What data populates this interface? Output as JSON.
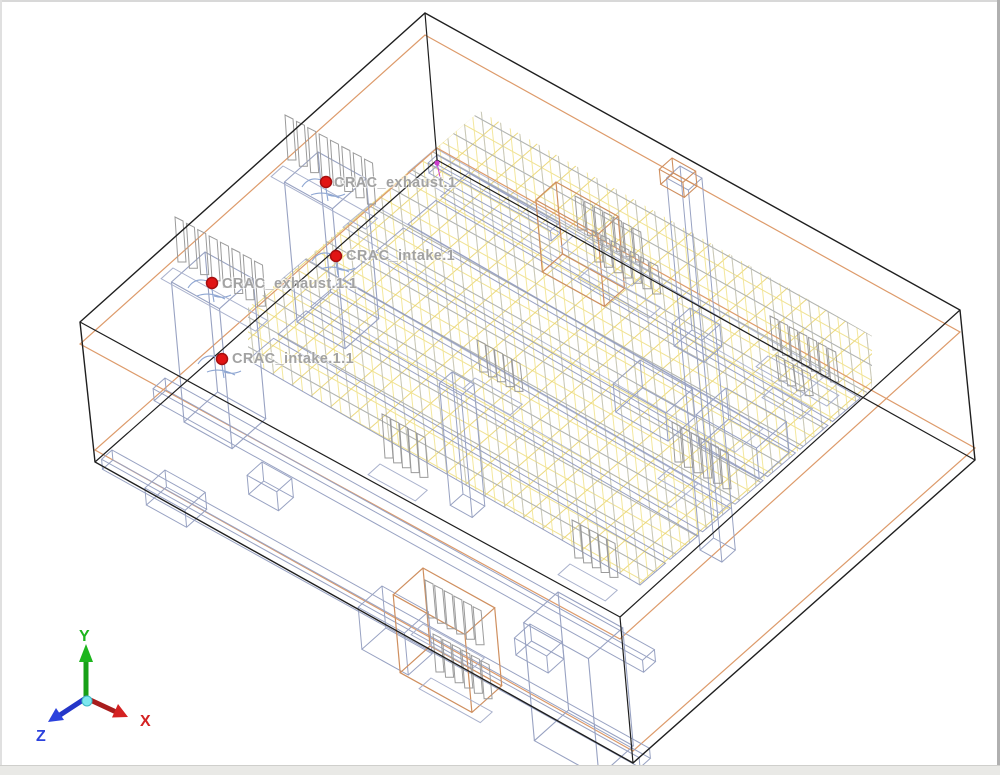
{
  "app": {
    "view_name": "3d-model-viewport"
  },
  "probes": [
    {
      "label": "CRAC_exhaust.1"
    },
    {
      "label": "CRAC_intake.1"
    },
    {
      "label": "CRAC_exhaust.1.1"
    },
    {
      "label": "CRAC_intake.1.1"
    }
  ],
  "axis": {
    "x": "X",
    "y": "Y",
    "z": "Z"
  },
  "colors": {
    "background": "#ffffff",
    "room_edge": "#1f1f1f",
    "plane_orange": "#dd9b6b",
    "object_orange": "#cf8f5f",
    "rack_slate": "#98a2c2",
    "rack_slate_light": "#aab2cd",
    "row_slate": "#8e98bc",
    "mesh_yellow": "#efe08c",
    "mesh_yellow_steep": "#f2e492",
    "mesh_yellow_deep": "#e9d470",
    "fin_gray": "#9b9b9b",
    "probe_red": "#e11414",
    "probe_ring": "#a50f0f",
    "fan_blue": "#8ea6d2",
    "marker_magenta": "#cc3ecc",
    "label_gray": "#a2a2a2",
    "axis_x_red": "#d42222",
    "axis_x_shaft": "#a81d1d",
    "axis_y_green": "#1db51d",
    "axis_y_shaft": "#17a017",
    "axis_z_blue": "#2c42dd",
    "axis_z_shaft": "#2436c8",
    "origin_cyan": "#7de8ef",
    "origin_ring": "#3db8c4",
    "border_top": "#d8d8d8",
    "border_left": "#e0e0e0",
    "border_right": "#b0b0b0",
    "border_bottom": "#e9e9e6",
    "border_bottom_line": "#cfcfcc"
  }
}
